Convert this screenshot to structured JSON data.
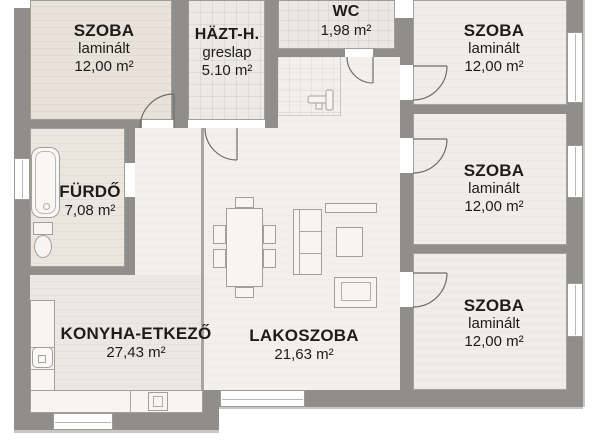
{
  "floor_plan": {
    "rooms": [
      {
        "id": "szoba-top-left",
        "name": "SZOBA",
        "material": "laminált",
        "area": "12,00 m²"
      },
      {
        "id": "haztartasi",
        "name": "HÄZT-H.",
        "material": "greslap",
        "area": "5.10 m²"
      },
      {
        "id": "wc",
        "name": "WC",
        "area": "1,98 m²"
      },
      {
        "id": "szoba-top-right",
        "name": "SZOBA",
        "material": "laminált",
        "area": "12,00 m²"
      },
      {
        "id": "szoba-middle-right",
        "name": "SZOBA",
        "material": "laminált",
        "area": "12,00 m²"
      },
      {
        "id": "furdo",
        "name": "FÜRDŐ",
        "area": "7,08 m²"
      },
      {
        "id": "konyha-etkezo",
        "name": "KONYHA-ETKEZŐ",
        "area": "27,43 m²"
      },
      {
        "id": "lakoszoba",
        "name": "LAKOSZOBA",
        "area": "21,63 m²"
      },
      {
        "id": "szoba-bottom-right",
        "name": "SZOBA",
        "material": "laminált",
        "area": "12,00 m²"
      }
    ],
    "fixtures": [
      "bathtub-icon",
      "toilet-icon",
      "kitchen-sink-icon",
      "cooktop-icon",
      "dining-table",
      "dining-chair",
      "sofa",
      "sideboard",
      "coffee-table",
      "armchair",
      "key-icon"
    ],
    "colors": {
      "wall": "#8f8e8a",
      "floor_hall": "#f2f0ec",
      "floor_wood": "#e9e2db",
      "floor_room": "#efede9",
      "window": "#ffffff",
      "text": "#1d1c19"
    }
  }
}
